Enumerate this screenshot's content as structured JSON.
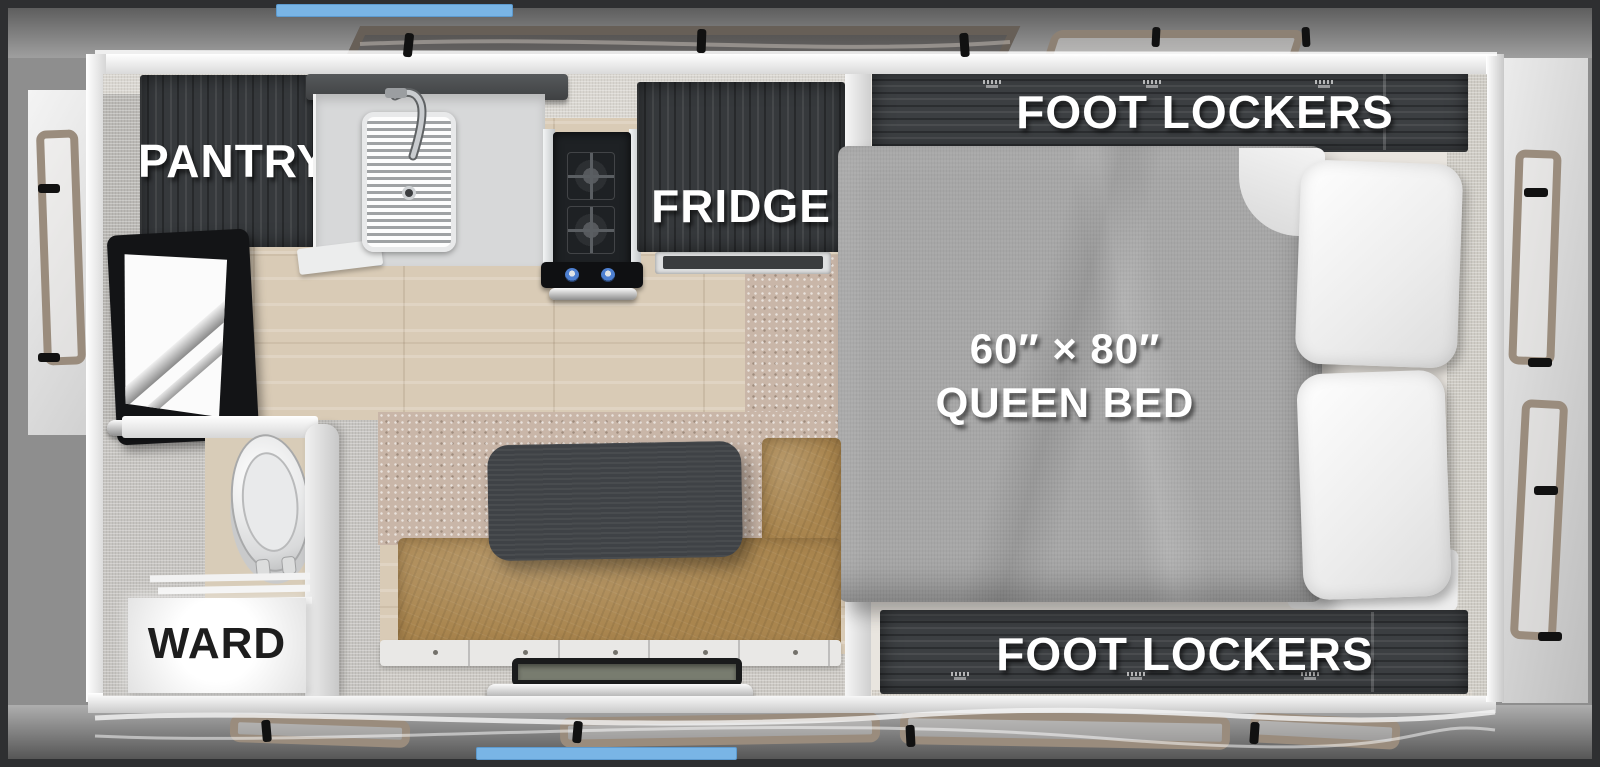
{
  "scene": {
    "type": "RV truck camper floor plan, top-down 3D render",
    "accent_blue": "#79b5e6",
    "cabinet_wood": "#36393c",
    "leather_tan": "#a9854e",
    "bed_fabric": "#a6a6a6",
    "carpet": "#c9b6a8",
    "wood_floor": "#d9cbb6"
  },
  "labels": {
    "pantry": "PANTRY",
    "fridge": "FRIDGE",
    "foot_lockers_top": "FOOT LOCKERS",
    "bed_dimensions": "60″ × 80″",
    "bed_name": "QUEEN BED",
    "foot_lockers_bottom": "FOOT LOCKERS",
    "ward": "WARD"
  },
  "fixtures": [
    "pantry-cabinet",
    "overhead-shelf",
    "kitchen-sink",
    "faucet",
    "two-burner-cooktop",
    "oven-handle",
    "fridge-cabinet",
    "foot-lockers-top",
    "queen-bed",
    "pillows",
    "foot-lockers-bottom",
    "tv",
    "toilet",
    "wardrobe",
    "dinette-table",
    "dinette-bench",
    "entry-step",
    "side-windows",
    "roof-rails",
    "clearance-markers"
  ]
}
